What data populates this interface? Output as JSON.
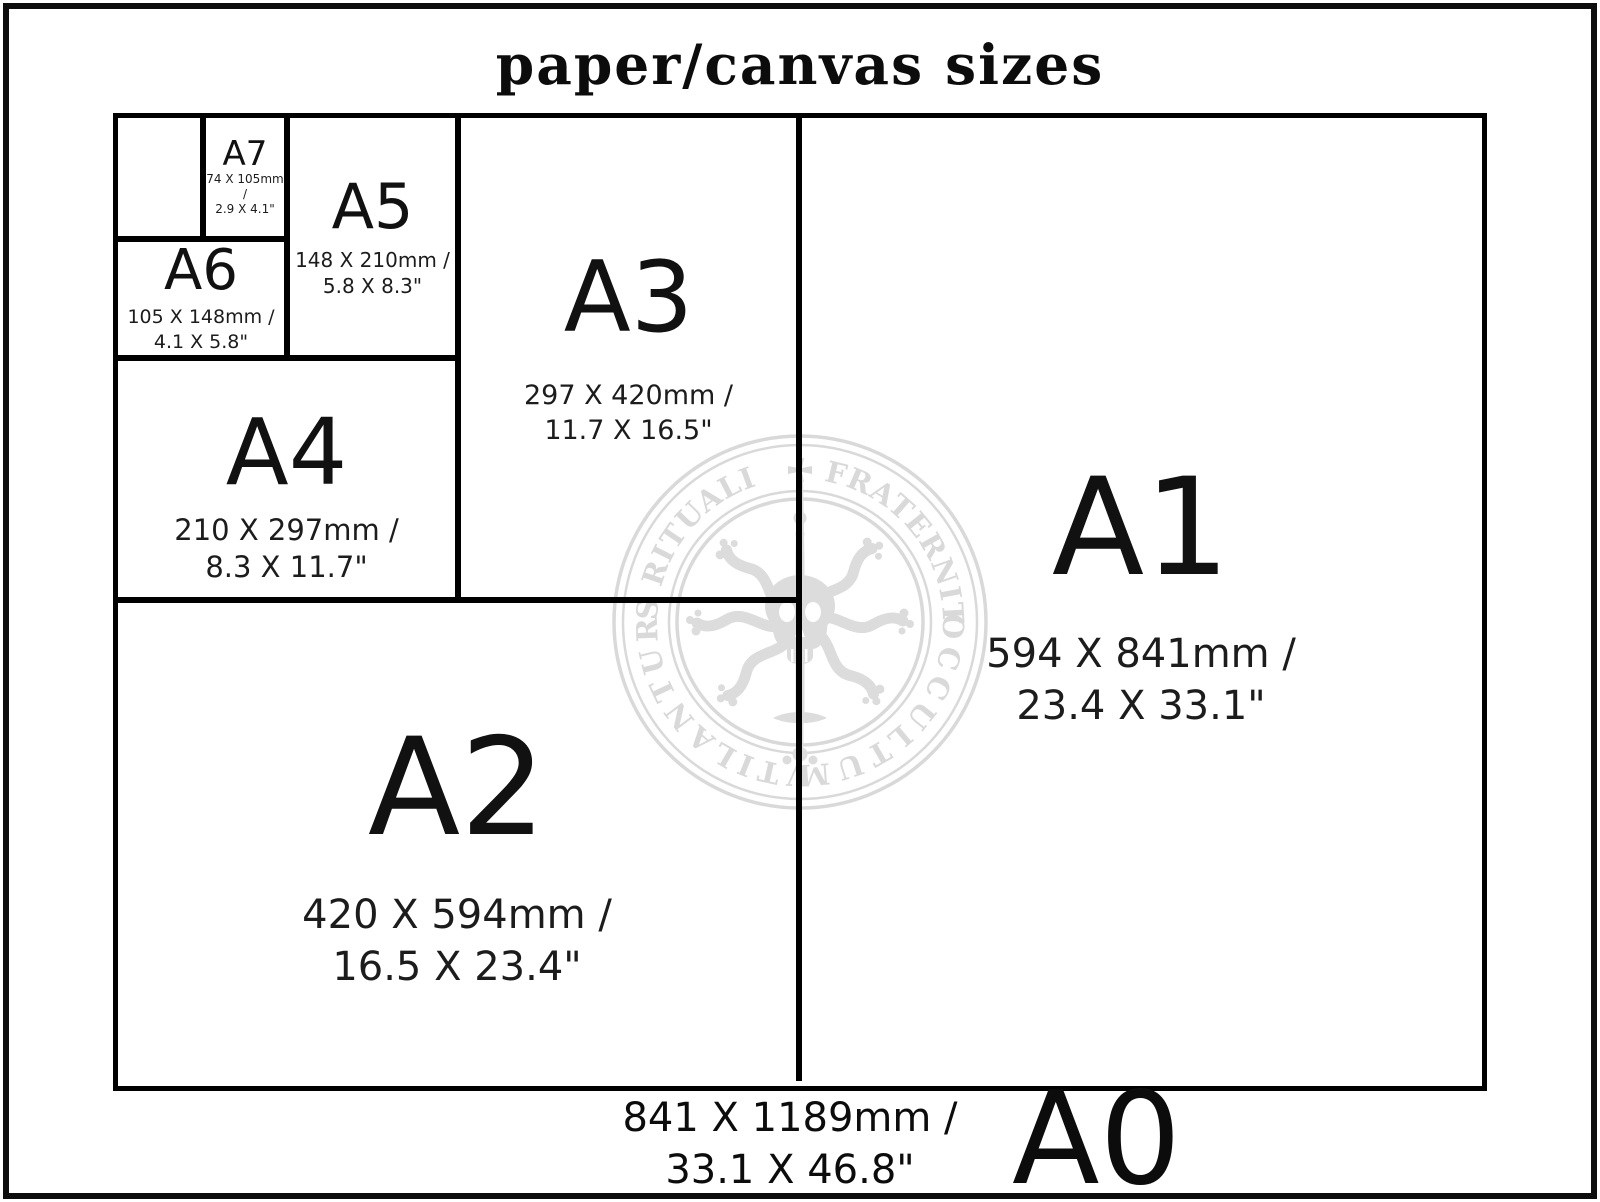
{
  "title": "paper/canvas sizes",
  "sizes": {
    "a7": {
      "label": "A7",
      "mm": "74 X 105mm /",
      "inches": "2.9 X 4.1\""
    },
    "a6": {
      "label": "A6",
      "mm": "105 X 148mm /",
      "inches": "4.1 X 5.8\""
    },
    "a5": {
      "label": "A5",
      "mm": "148 X 210mm /",
      "inches": "5.8 X 8.3\""
    },
    "a4": {
      "label": "A4",
      "mm": "210 X 297mm /",
      "inches": "8.3 X 11.7\""
    },
    "a3": {
      "label": "A3",
      "mm": "297 X 420mm /",
      "inches": "11.7 X 16.5\""
    },
    "a2": {
      "label": "A2",
      "mm": "420 X 594mm /",
      "inches": "16.5 X 23.4\""
    },
    "a1": {
      "label": "A1",
      "mm": "594 X 841mm /",
      "inches": "23.4 X 33.1\""
    },
    "a0": {
      "label": "A0",
      "mm": "841 X 1189mm /",
      "inches": "33.1 X 46.8\""
    }
  },
  "watermark": {
    "arc_top": "ARS RITUALI      FRATERNITAS",
    "arc_bottom_right": "OCCULTUM",
    "arc_bottom_left": "VTILANTUR",
    "cross_icon": "maltese-cross",
    "emblem": "skull-with-six-tentacles-and-sword",
    "color": "#d9d9d9"
  }
}
